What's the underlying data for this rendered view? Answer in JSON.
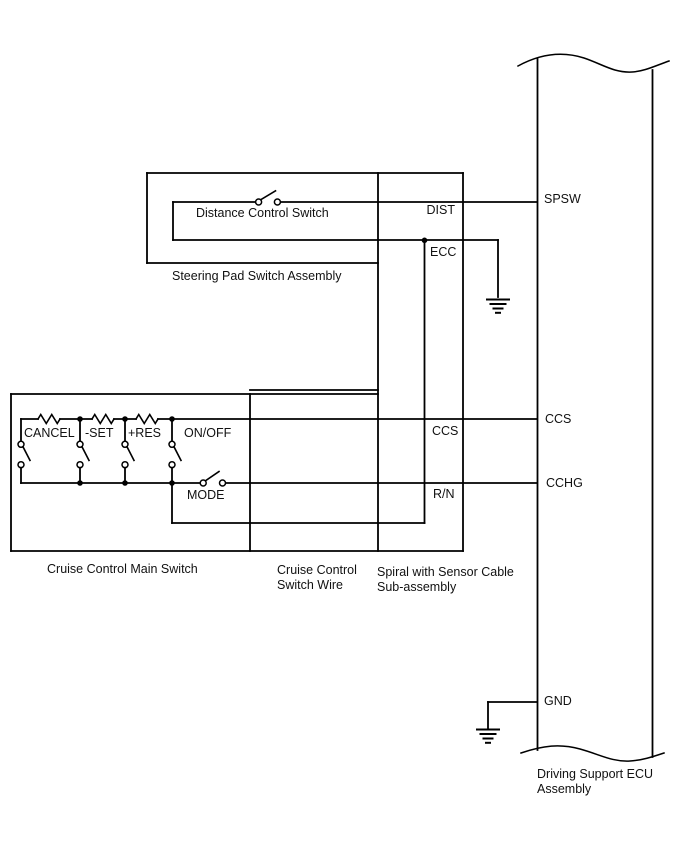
{
  "labels": {
    "steering_assembly": "Steering Pad Switch Assembly",
    "distance_switch": "Distance Control Switch",
    "main_switch": "Cruise Control Main Switch",
    "switch_wire_1": "Cruise Control",
    "switch_wire_2": "Switch Wire",
    "spiral_1": "Spiral with Sensor Cable",
    "spiral_2": "Sub-assembly",
    "ecu_1": "Driving Support ECU",
    "ecu_2": "Assembly"
  },
  "switches": {
    "cancel": "CANCEL",
    "set": "-SET",
    "res": "+RES",
    "onoff": "ON/OFF",
    "mode": "MODE"
  },
  "wires": {
    "dist": "DIST",
    "ecc": "ECC",
    "ccs_spiral": "CCS",
    "rn": "R/N"
  },
  "ecu_terminals": {
    "spsw": "SPSW",
    "ccs": "CCS",
    "cchg": "CCHG",
    "gnd": "GND"
  },
  "colors": {
    "line": "#000000",
    "text": "#111111",
    "background": "#ffffff"
  }
}
